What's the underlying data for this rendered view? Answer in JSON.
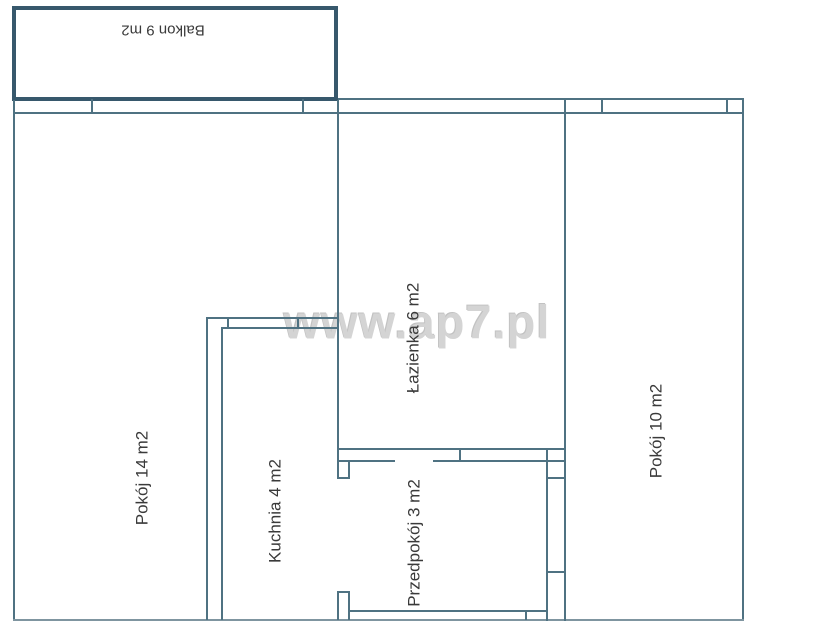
{
  "plan": {
    "type": "apartment-floor-plan",
    "watermark": {
      "text": "www.ap7.pl",
      "color": "#d4d4d4"
    },
    "colors": {
      "wall_line": "#4f7282",
      "balcony_border": "#37586c",
      "bottom_wall": "#7f95a0",
      "label_text": "#3a3a3a",
      "background": "#ffffff"
    },
    "total_rooms": 6,
    "rooms": [
      {
        "name": "Balkon",
        "area_m2": 9,
        "label": "Balkon 9 m2",
        "text_rotation_deg": 180
      },
      {
        "name": "Pokój",
        "area_m2": 14,
        "label": "Pokój 14 m2",
        "text_rotation_deg": -90
      },
      {
        "name": "Kuchnia",
        "area_m2": 4,
        "label": "Kuchnia 4 m2",
        "text_rotation_deg": -90
      },
      {
        "name": "Łazienka",
        "area_m2": 6,
        "label": "Łazienka 6 m2",
        "text_rotation_deg": -90
      },
      {
        "name": "Przedpokój",
        "area_m2": 3,
        "label": "Przedpokój 3 m2",
        "text_rotation_deg": -90
      },
      {
        "name": "Pokój",
        "area_m2": 10,
        "label": "Pokój 10 m2",
        "text_rotation_deg": -90
      }
    ]
  }
}
